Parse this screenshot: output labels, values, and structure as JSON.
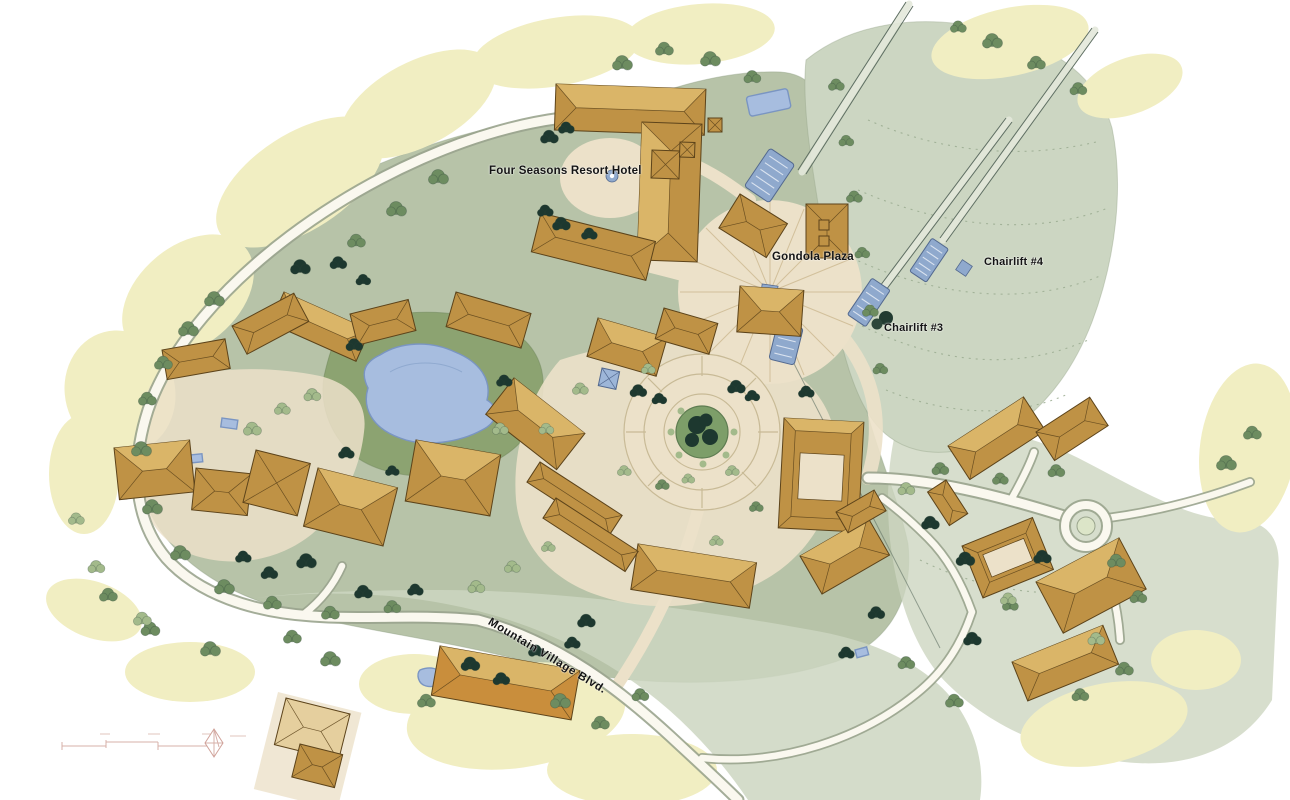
{
  "labels": {
    "four_seasons": "Four Seasons Resort Hotel",
    "gondola_plaza": "Gondola Plaza",
    "chairlift_3": "Chairlift #3",
    "chairlift_4": "Chairlift #4",
    "boulevard": "Mountain Village Blvd."
  },
  "map_features": [
    "four-seasons-resort-hotel",
    "hotel-courtyard-fountain",
    "swimming-pool",
    "gondola-plaza",
    "gondola-terminal-upper",
    "gondola-terminal-lower",
    "chairlift-3-station",
    "chairlift-4-station",
    "ski-slope",
    "central-plaza-circle",
    "village-pond",
    "mountain-village-blvd",
    "roundabout",
    "east-condo-buildings",
    "west-village-buildings",
    "south-village-buildings",
    "scale-bar",
    "north-arrow"
  ],
  "colors": {
    "paper": "#ffffff",
    "canopy": "#f1eec2",
    "sage": "#b7c3a8",
    "slope": "#ccd6c2",
    "wash": "#cdd6c1",
    "lawn": "#8ca371",
    "cream": "#ece1c9",
    "road_fill": "#faf8ef",
    "road_edge": "#9aa48e",
    "roof": "#bf9245",
    "roof_light": "#dbb76a",
    "roof_line": "#5c431a",
    "roof_pale": "#e5cf9e",
    "tree_dark": "#1d382f",
    "tree_mid": "#6d8c60",
    "tree_light": "#a3ba8b",
    "water": "#a7bddf",
    "water_edge": "#7a95c2",
    "lift_blue": "#8fa9cd",
    "lift_blue_dark": "#53698f",
    "cable": "#5f6f63",
    "label_ink": "#141414",
    "scale_pink": "#d0a29a"
  }
}
